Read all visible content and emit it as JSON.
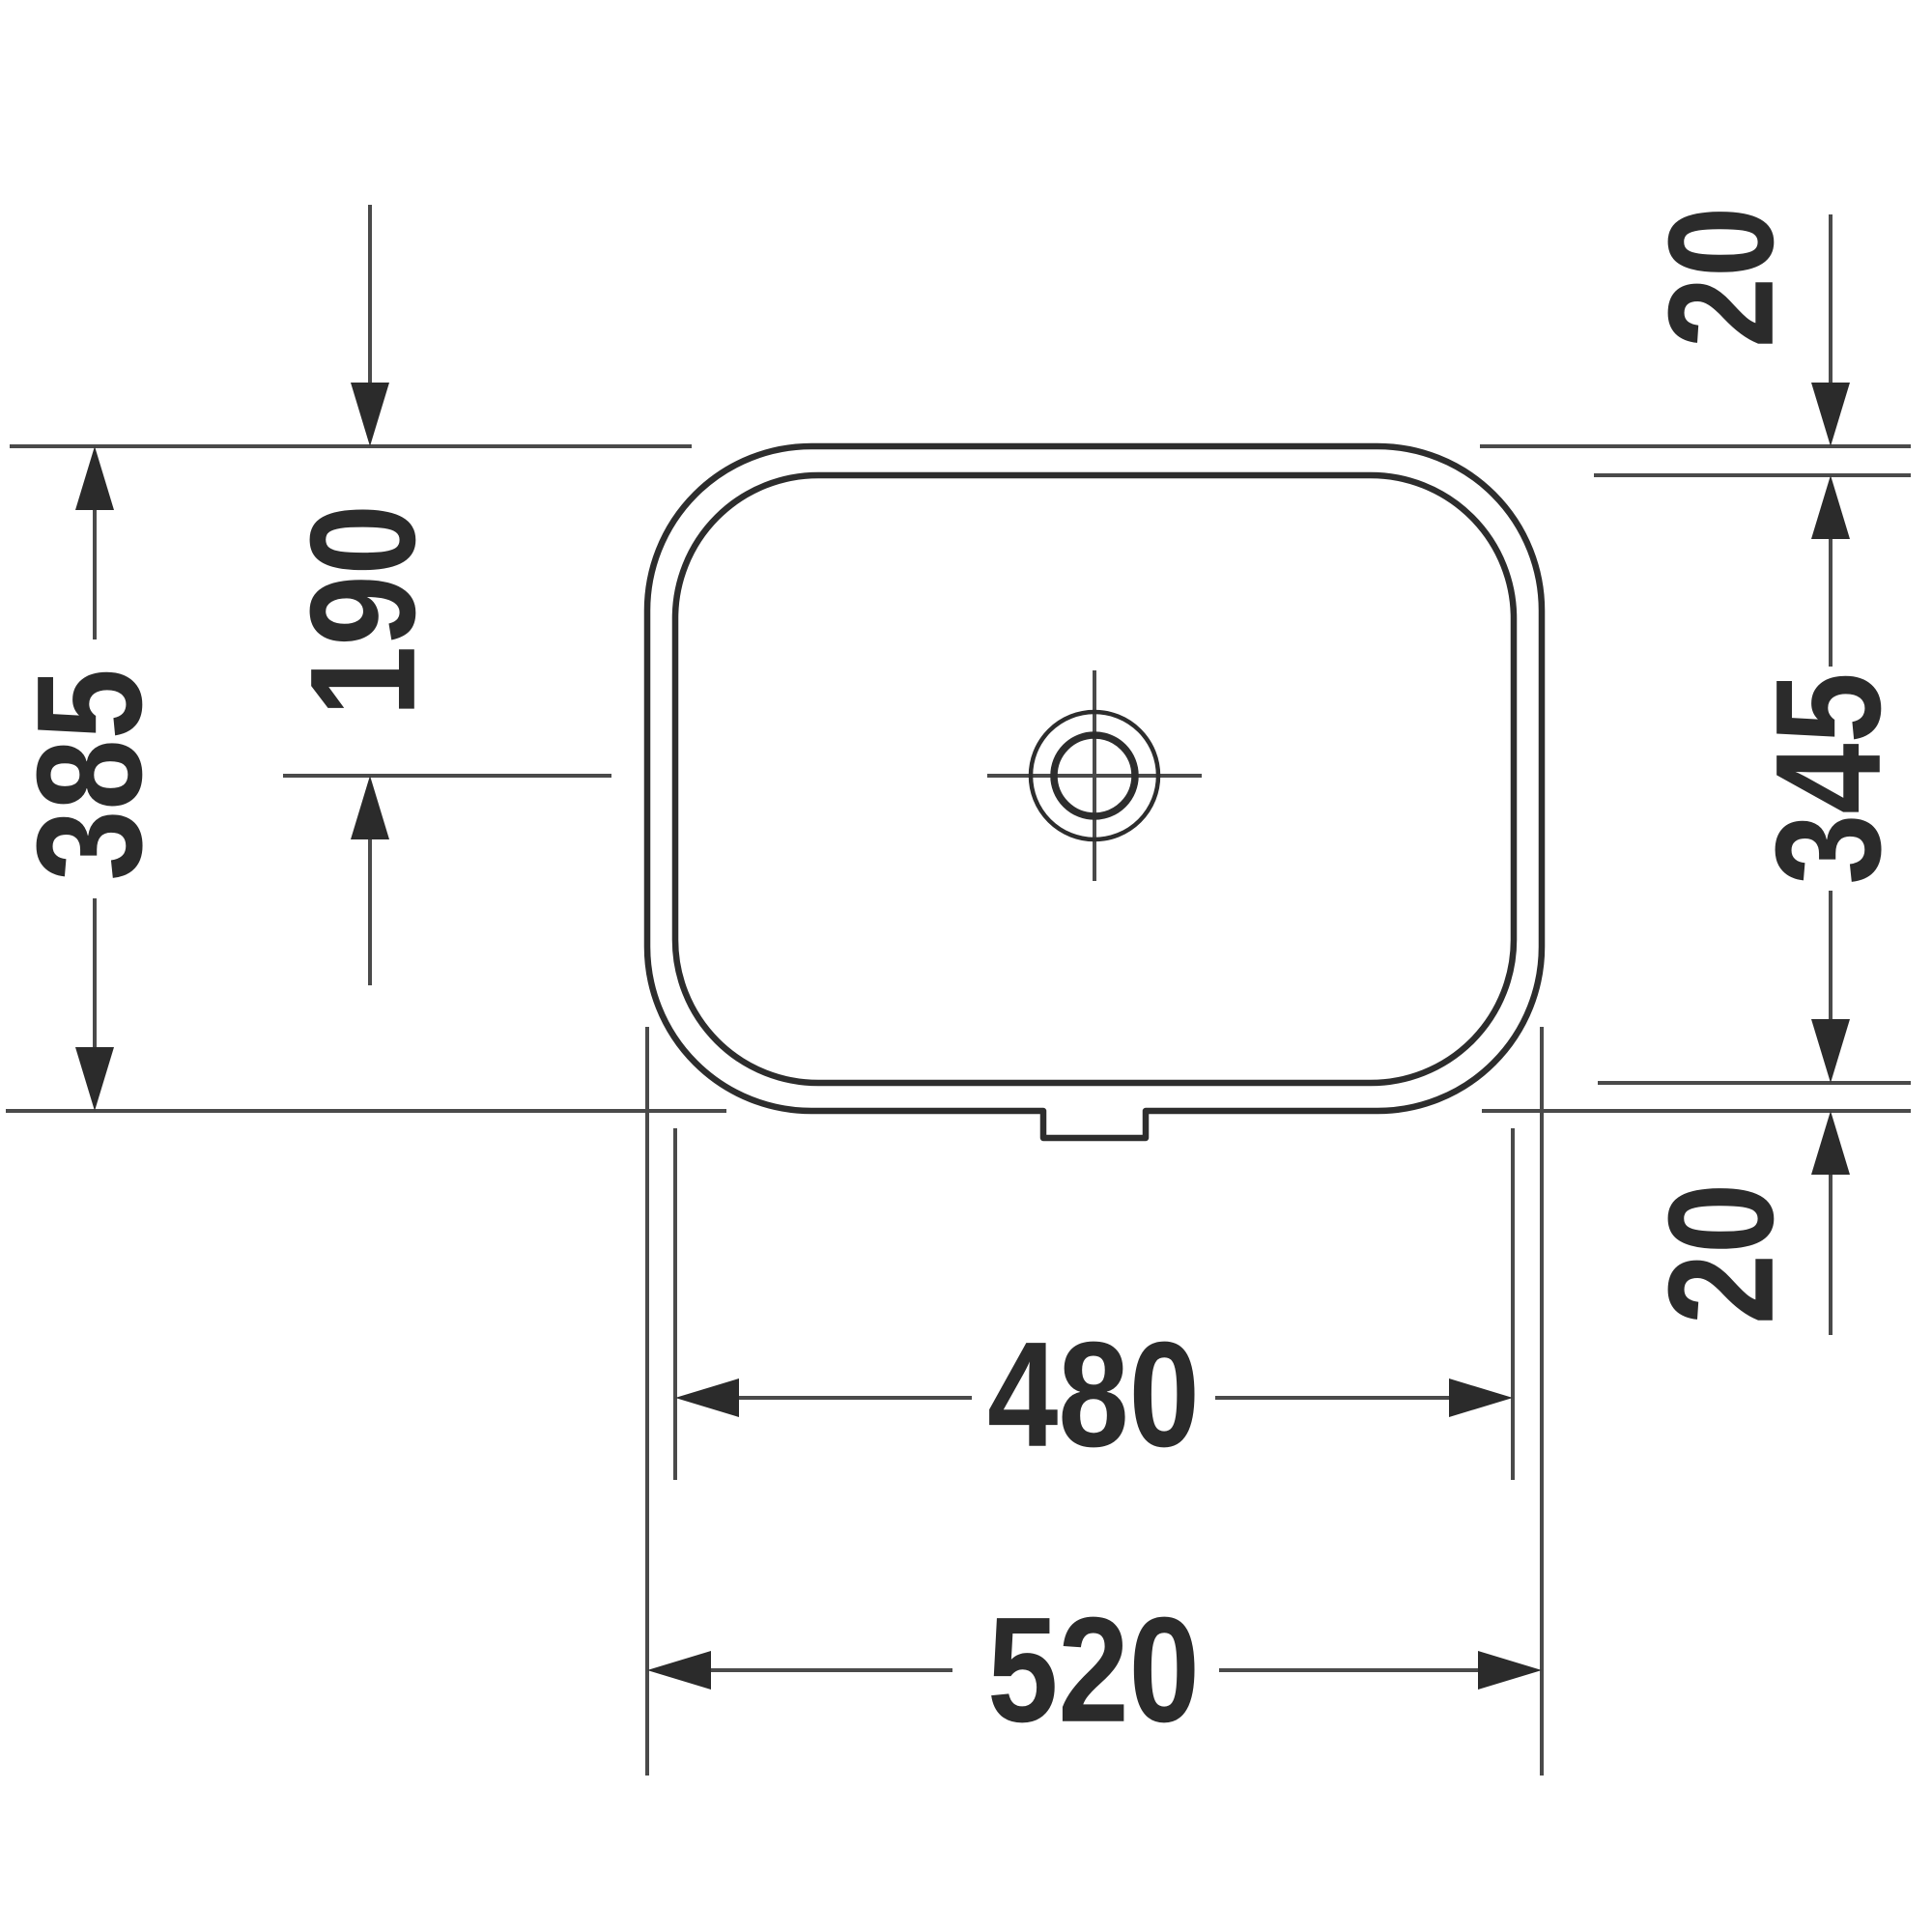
{
  "document": {
    "kind": "technical dimension drawing",
    "view": "rectangular undercounter washbasin, plan view",
    "units": "mm"
  },
  "labels": {
    "overall_depth": "385",
    "drain_center_from_back": "190",
    "rim_top": "20",
    "basin_depth": "345",
    "rim_bottom": "20",
    "basin_width": "480",
    "overall_width": "520"
  },
  "colors": {
    "background": "#ffffff",
    "outline": "#2d2d2d",
    "thin_line": "#4a4a4a",
    "text": "#2b2b2b"
  }
}
